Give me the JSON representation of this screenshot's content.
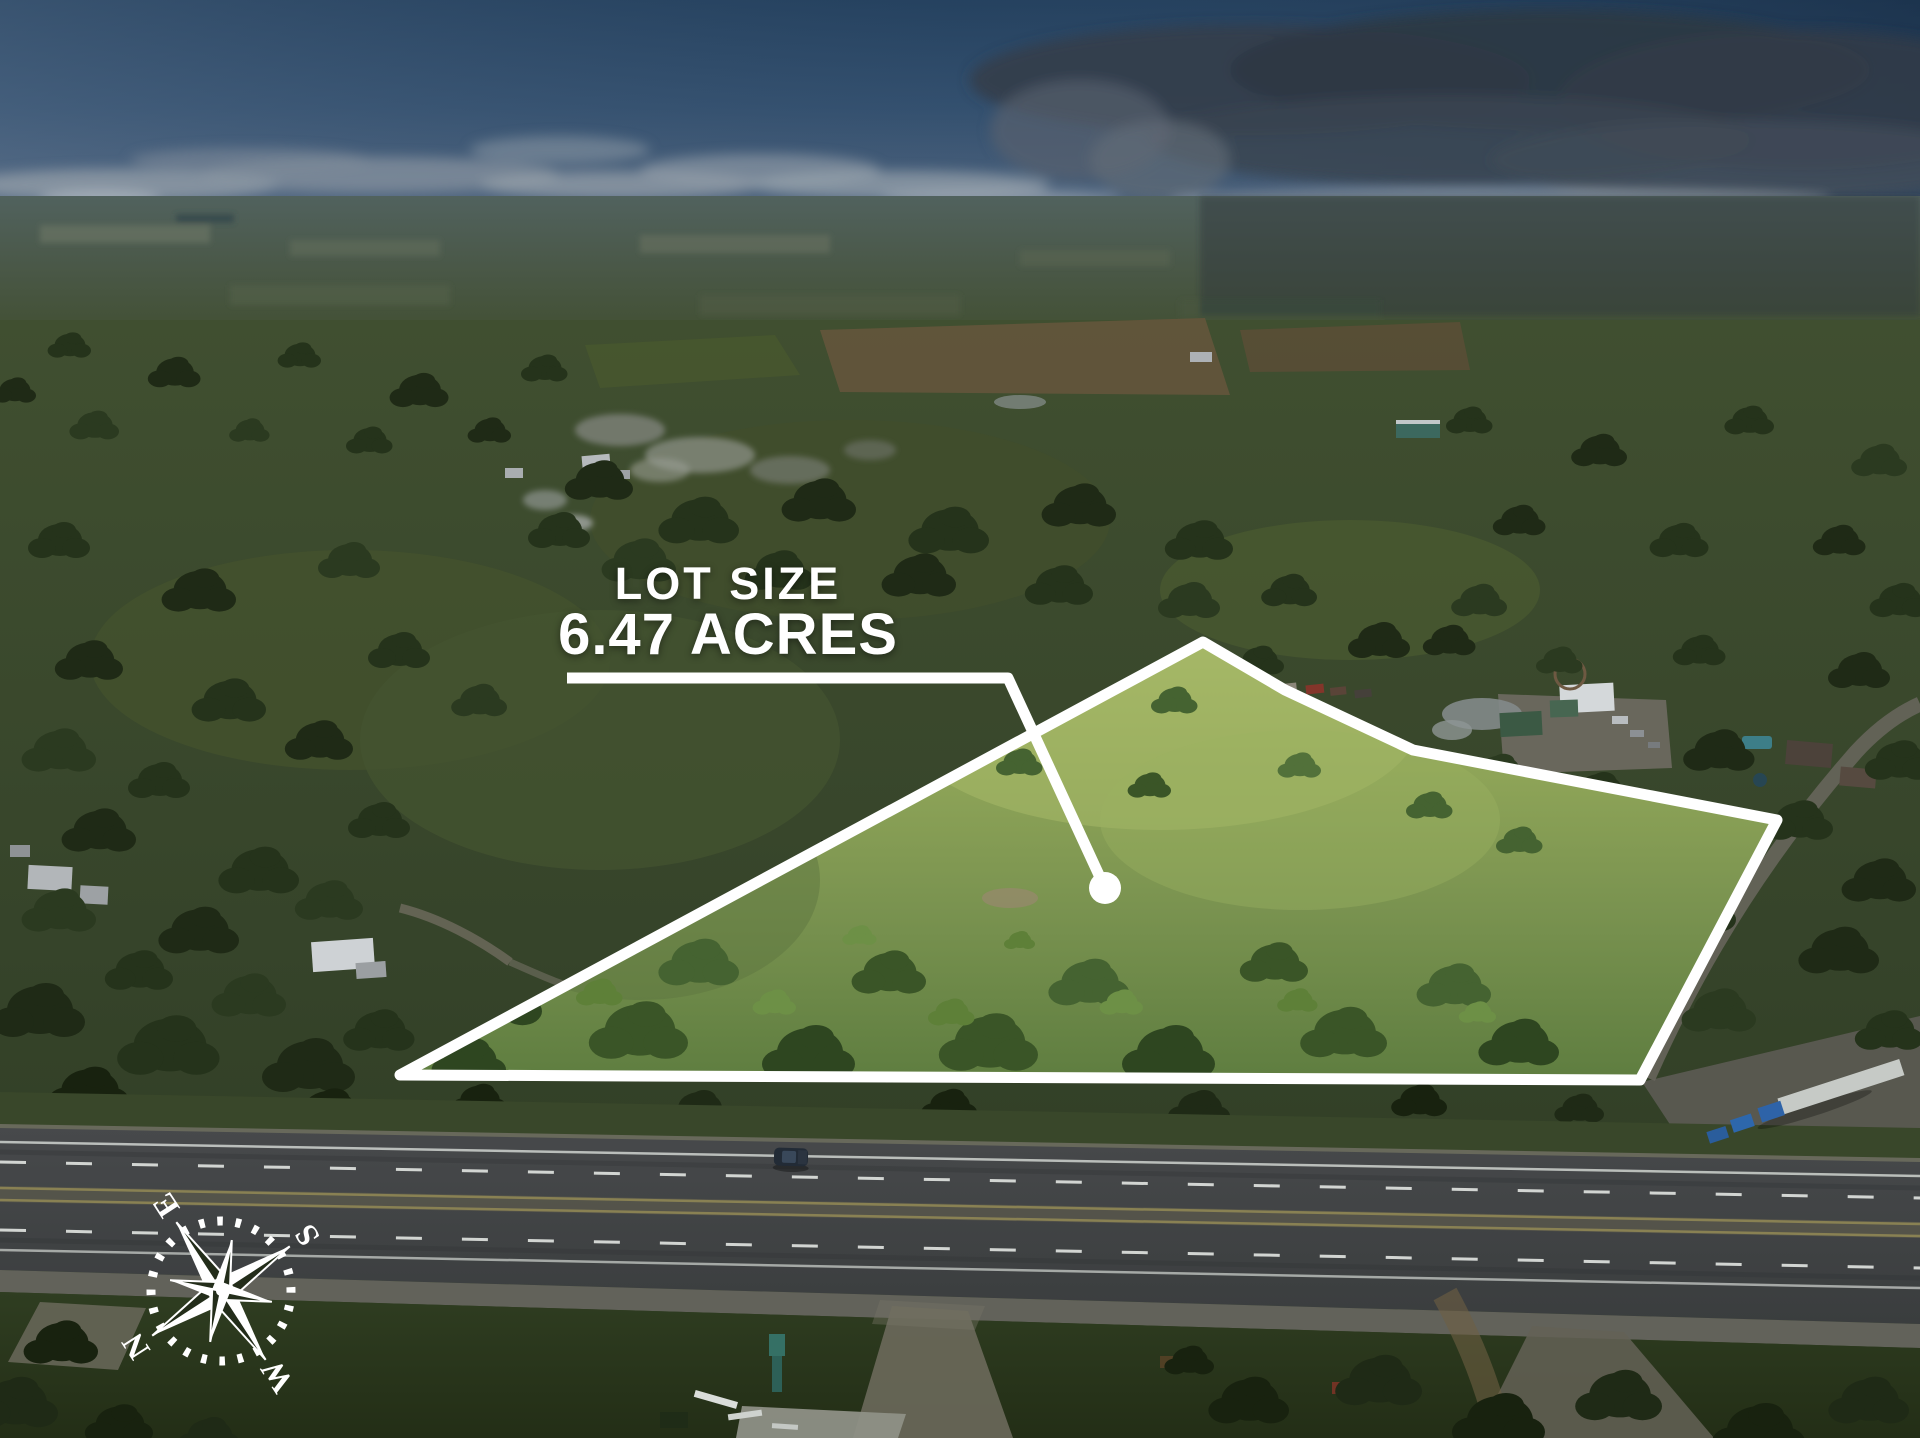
{
  "scene": {
    "type": "aerial-drone-photo",
    "subject": "Rural acreage for sale: highlighted lot beside a divided highway, Texas hill country",
    "colors": {
      "overlay_white": "#ffffff",
      "sky_top": "#24415f",
      "smoke_cloud": "#2d3844",
      "dim_field_green": "#36442a",
      "lot_highlight_green": "#8fa558",
      "asphalt": "#3f4244"
    }
  },
  "overlay": {
    "lot_label_title": "LOT SIZE",
    "lot_label_value": "6.47 ACRES",
    "boundary_points": "1203,642 1285,690 1413,750 1777,820 1640,1080 400,1075",
    "leader_path": "M 567 678 L 1008 678 L 1105 888",
    "marker_x": "1105",
    "marker_y": "888",
    "marker_r": "16",
    "color": "#ffffff"
  },
  "compass": {
    "letter_n": "N",
    "letter_e": "E",
    "letter_s": "S",
    "letter_w": "W",
    "rotation": "rotate(-123)"
  }
}
